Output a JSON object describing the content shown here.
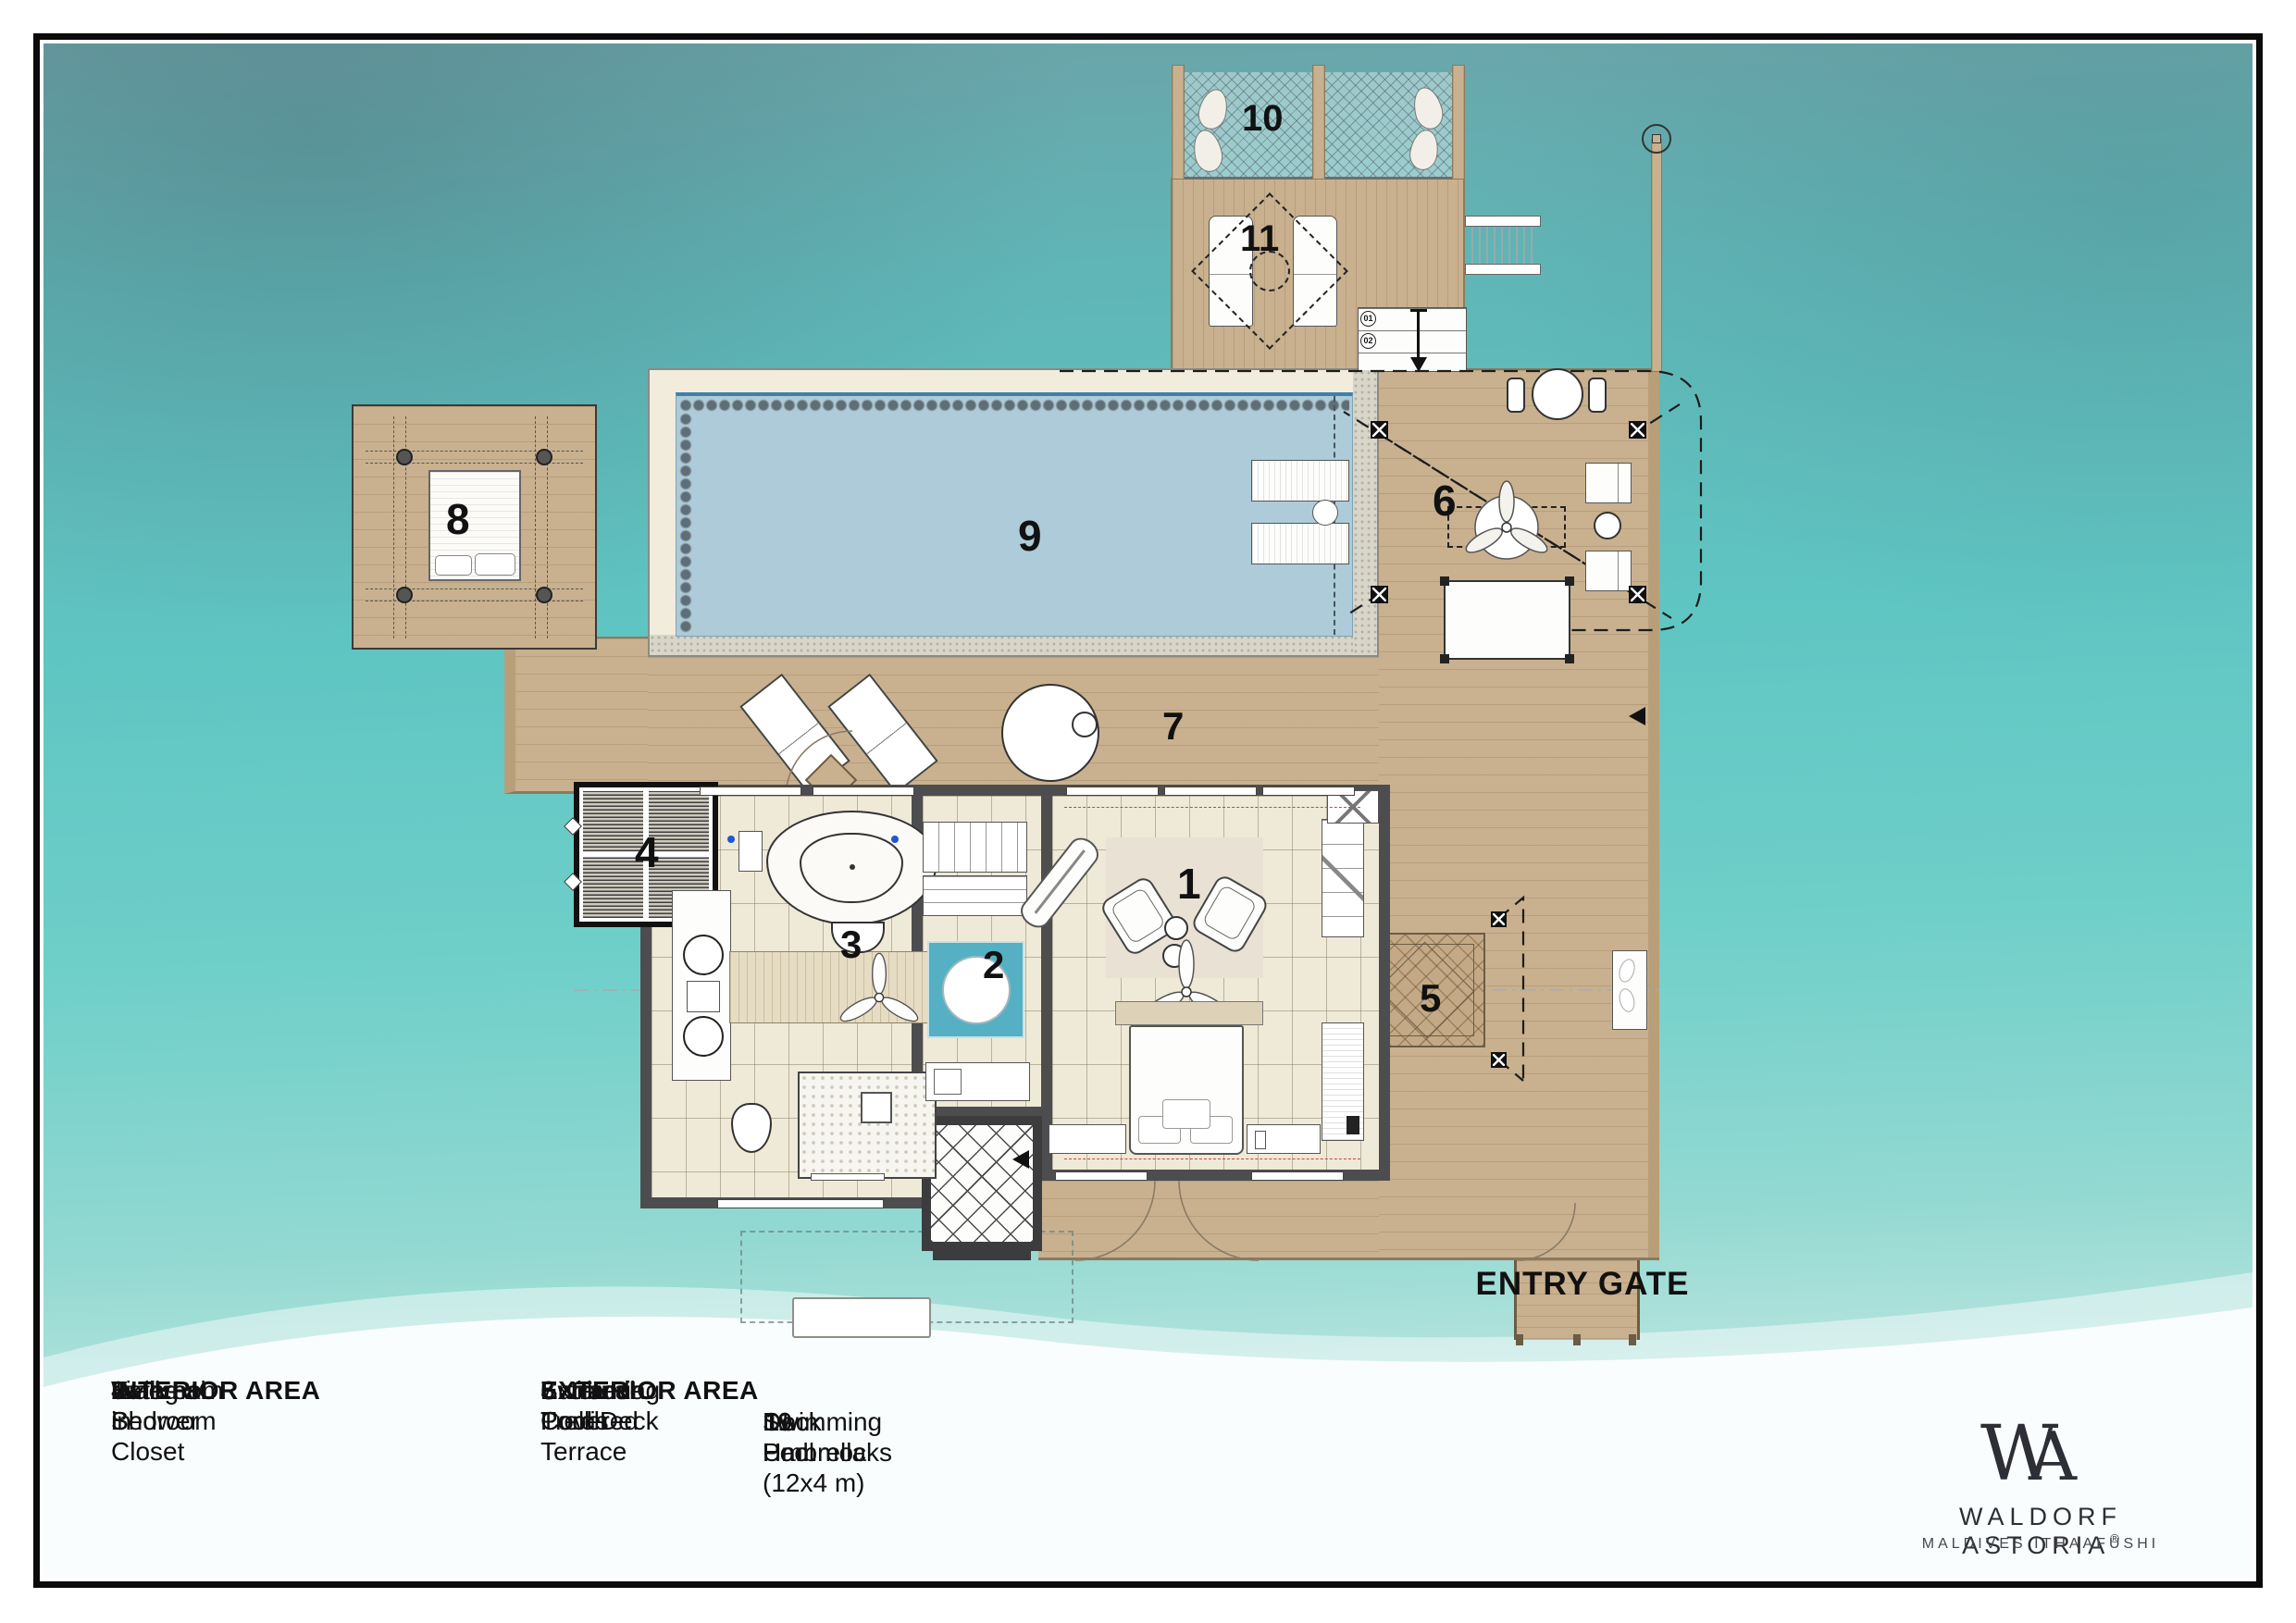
{
  "plan": {
    "markers": {
      "m1": "1",
      "m2": "2",
      "m3": "3",
      "m4": "4",
      "m5": "5",
      "m6": "6",
      "m7": "7",
      "m8": "8",
      "m9": "9",
      "m10": "10",
      "m11": "11"
    },
    "entry_gate_label": "ENTRY GATE",
    "stair_step_labels": [
      "01",
      "02"
    ]
  },
  "legend": {
    "interior": {
      "title": "INTERIOR AREA",
      "items": [
        {
          "num": "1",
          "label": "Living + Bedroom"
        },
        {
          "num": "2",
          "label": "Walk-in Closet"
        },
        {
          "num": "3",
          "label": "Bathroom"
        },
        {
          "num": "4",
          "label": "External Shower"
        }
      ]
    },
    "exterior": {
      "title": "EXTERIOR AREA",
      "items": [
        {
          "num": "5",
          "label": "Entrance Porch"
        },
        {
          "num": "6",
          "label": "External Covered Terrace"
        },
        {
          "num": "7",
          "label": "Swimming Pool Deck"
        },
        {
          "num": "8",
          "label": "Sunbed Trellis"
        }
      ]
    },
    "exterior2": {
      "items": [
        {
          "num": "9",
          "label": "Swimming Pool (12x4 m)"
        },
        {
          "num": "10",
          "label": "Dock Hammocks"
        },
        {
          "num": "11",
          "label": "Deck Umbrella"
        }
      ]
    }
  },
  "brand": {
    "monogram_w": "W",
    "monogram_a": "A",
    "name": "WALDORF ASTORIA",
    "registered": "®",
    "location": "MALDIVES ITHAAFUSHI"
  },
  "colors": {
    "ocean": "#5fc5c2",
    "deck": "#c9b18f",
    "pool_water": "#adcbd8",
    "closet_glass": "#55b0c4",
    "wall": "#4d4d4f"
  }
}
